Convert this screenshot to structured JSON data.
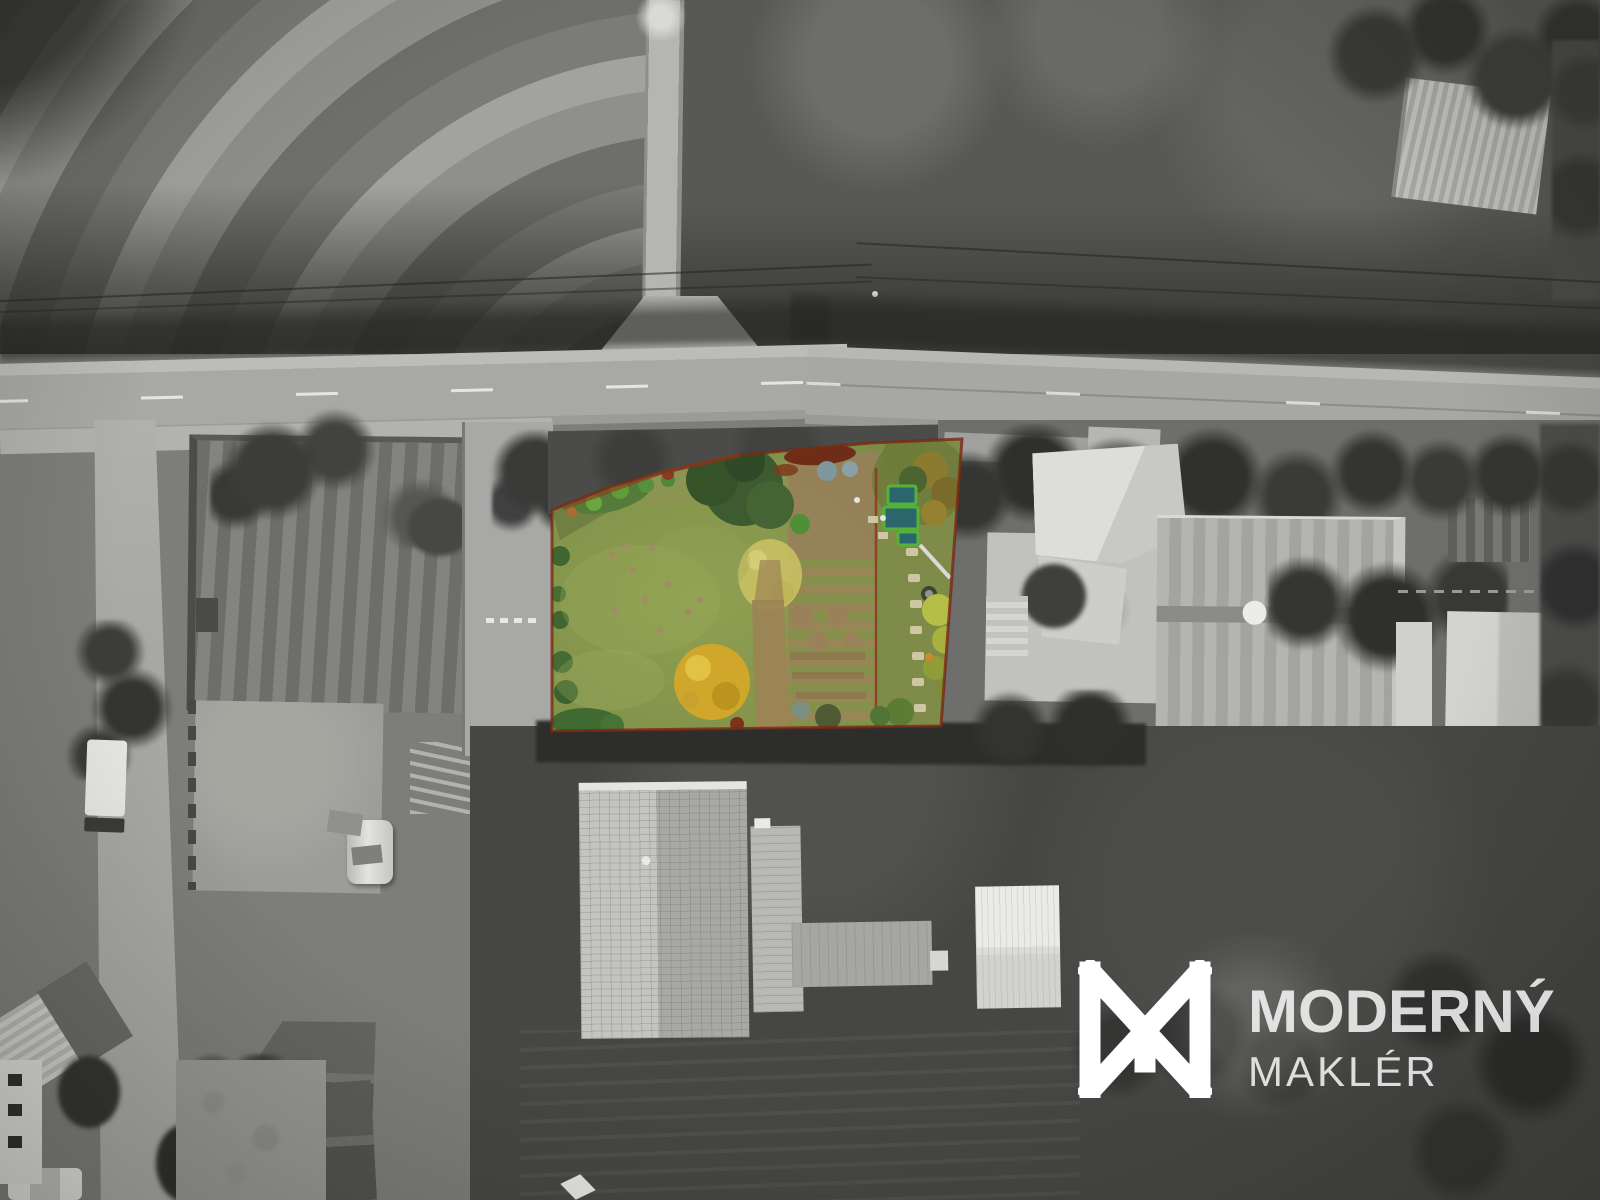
{
  "watermark": {
    "brand_top": "MODERNÝ",
    "brand_bottom": "MAKLÉR"
  },
  "highlight": {
    "lawn_green": "#82924A",
    "plot_boundary_red": "#7B2815",
    "autumn_tree_yellow": "#D0A72A",
    "pale_birch_yellow": "#CCC365",
    "raised_bed_cover_teal": "#2C666D",
    "raised_bed_frame_green": "#54B23A",
    "watermark_white": "#FFFFFF"
  }
}
